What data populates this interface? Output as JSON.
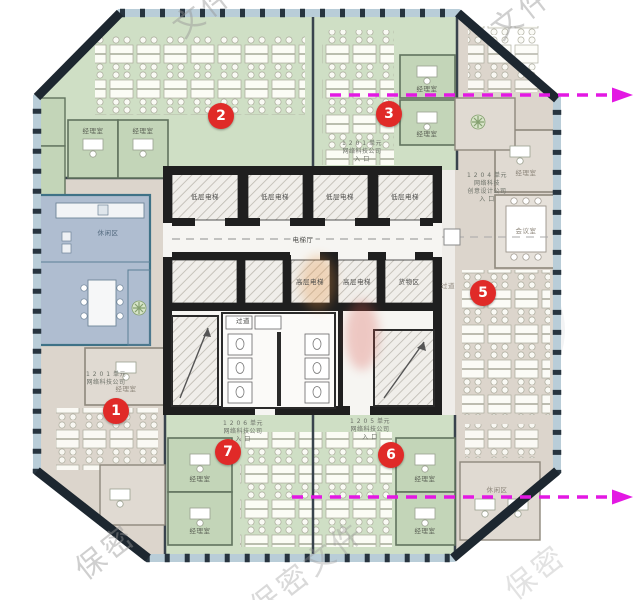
{
  "watermark": {
    "full_text": "保密文件",
    "fragments": {
      "top_left": "文件",
      "top_right": "文件",
      "bottom_left": "保密",
      "bottom_center": "保密文件",
      "bottom_right": "保密"
    }
  },
  "markers": {
    "zone1": "1",
    "zone2": "2",
    "zone3": "3",
    "zone5": "5",
    "zone6": "6",
    "zone7": "7"
  },
  "core": {
    "low_elevator": "低层电梯",
    "high_elevator": "高层电梯",
    "elevator_hall": "电梯厅",
    "cargo": "货物区",
    "corridor": "过道"
  },
  "rooms": {
    "manager": "经理室",
    "meeting": "会议室",
    "lounge": "休闲区"
  },
  "annotations": {
    "unit_top": {
      "lines": [
        "1 2 0 1 单元",
        "网络科技公司",
        "入 口"
      ]
    },
    "unit_right": {
      "lines": [
        "1 2 0 4 单元",
        "网络科技",
        "创意设计公司",
        "入 口"
      ]
    },
    "unit_left": {
      "lines": [
        "1 2 0 1 单元",
        "网络科技公司"
      ]
    },
    "unit_bottom_left": {
      "lines": [
        "1 2 0 6 单元",
        "网络科技公司",
        "入 口"
      ]
    },
    "unit_bottom_right": {
      "lines": [
        "1 2 0 5 单元",
        "网络科技公司",
        "入 口"
      ]
    }
  },
  "colors": {
    "zone_green": "#cfdfc5",
    "zone_beige": "#dcd5cc",
    "zone_blue": "#a9c3de",
    "marker_red": "#e02a28",
    "arrow_magenta": "#e318e3",
    "facade_dark": "#27343f",
    "core_wall": "#1f1f1f"
  }
}
